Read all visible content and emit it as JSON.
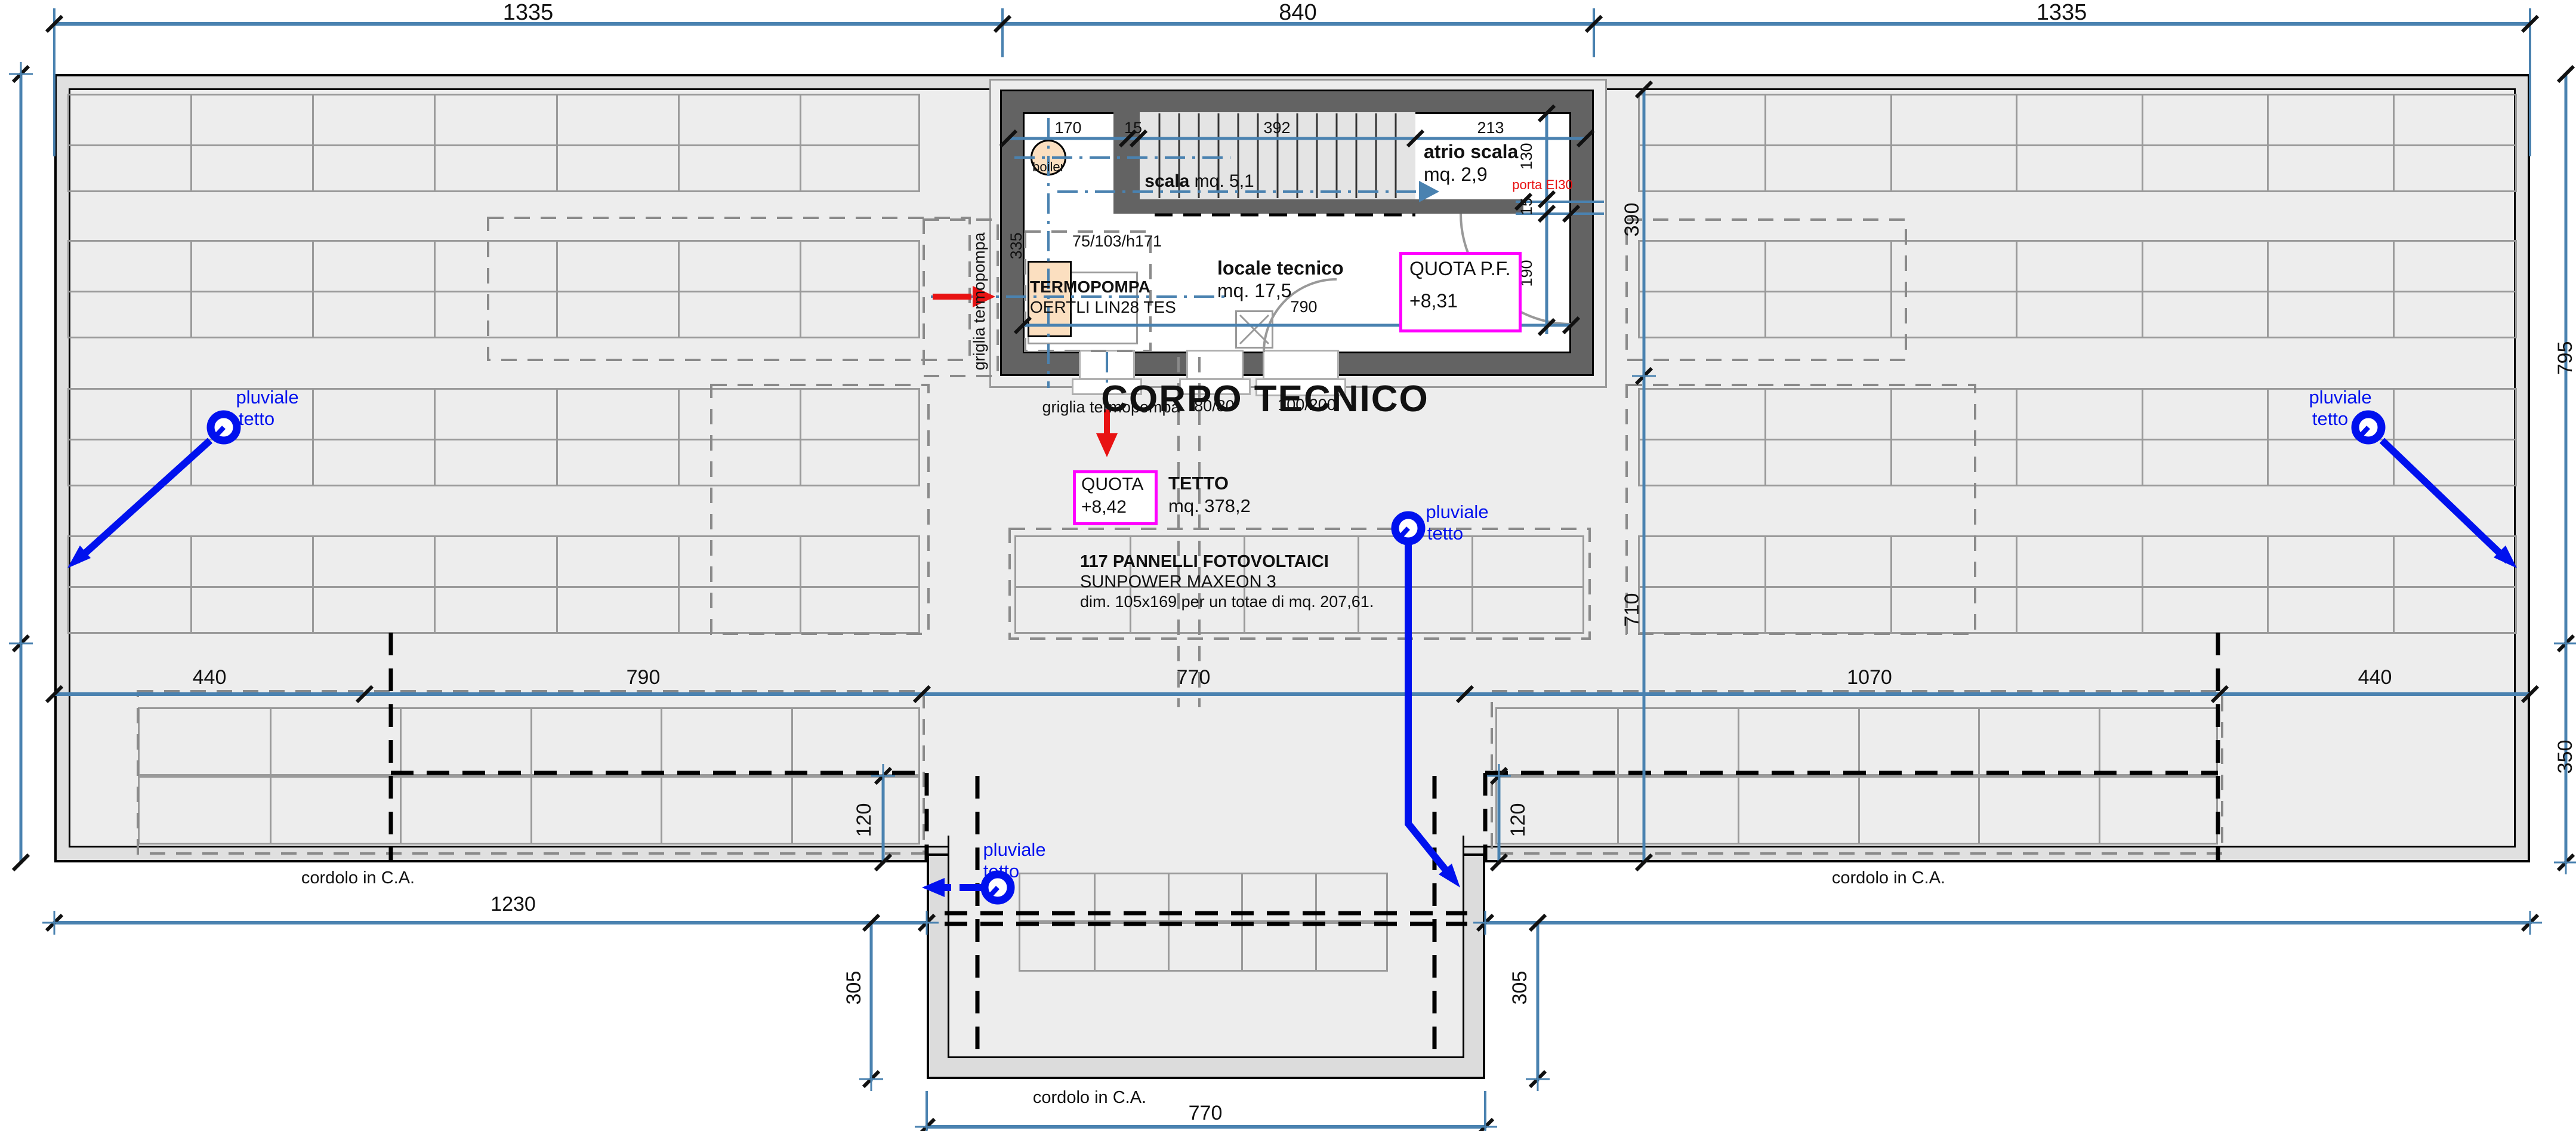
{
  "top_dims": {
    "left": "1335",
    "center": "840",
    "right": "1335"
  },
  "mid_dims": {
    "d440a": "440",
    "d790": "790",
    "d770": "770",
    "d1070": "1070",
    "d440b": "440"
  },
  "side_dims": {
    "v390": "390",
    "v710": "710",
    "left120": "120",
    "right120": "120",
    "left305": "305",
    "right305": "305",
    "bottom_left": "1230",
    "bottom_center": "770",
    "right_top": "795",
    "right_bottom": "350"
  },
  "corpo": {
    "title": "CORPO TECNICO",
    "dim_170": "170",
    "dim_15a": "15",
    "dim_392": "392",
    "dim_213": "213",
    "dim_130": "130",
    "dim_15b": "15",
    "dim_190": "190",
    "dim_335": "335",
    "dim_790": "790",
    "boiler": "boiler",
    "scala_bold": "scala",
    "scala_rest": "mq. 5,1",
    "atrio_line1": "atrio scala",
    "atrio_line2": "mq. 2,9",
    "porta": "porta EI30",
    "termopompa_line1": "TERMOPOMPA",
    "termopompa_line2": "OERTLI LIN28 TES",
    "unit_dim": "75/103/h171",
    "locale_line1": "locale tecnico",
    "locale_line2": "mq. 17,5",
    "quota_pf_line1": "QUOTA P.F.",
    "quota_pf_line2": "+8,31",
    "griglia_v": "griglia termopompa",
    "griglia_h": "griglia termopompa",
    "porta8080": "80/80",
    "porta100200": "100/200"
  },
  "roof": {
    "quota_line1": "QUOTA",
    "quota_line2": "+8,42",
    "tetto_line1": "TETTO",
    "tetto_line2": "mq. 378,2",
    "note_line1": "117 PANNELLI FOTOVOLTAICI",
    "note_line2": "SUNPOWER MAXEON 3",
    "note_line3": "dim. 105x169 per un totae di mq. 207,61.",
    "cordolo_left": "cordolo in C.A.",
    "cordolo_right": "cordolo in C.A.",
    "cordolo_bottom": "cordolo in C.A."
  },
  "pluviale": {
    "word1": "pluviale",
    "word2": "tetto"
  },
  "colors": {
    "dim_blue": "#4a82b0",
    "pluvial_blue": "#0011ee",
    "red": "#e81212",
    "magenta": "#ff00ff",
    "wall_gray": "#636363",
    "roof_fill": "#ededed",
    "edge_fill": "#e0e0e0",
    "panel_line": "#9a9a9a",
    "peach": "#fbdfc0"
  }
}
